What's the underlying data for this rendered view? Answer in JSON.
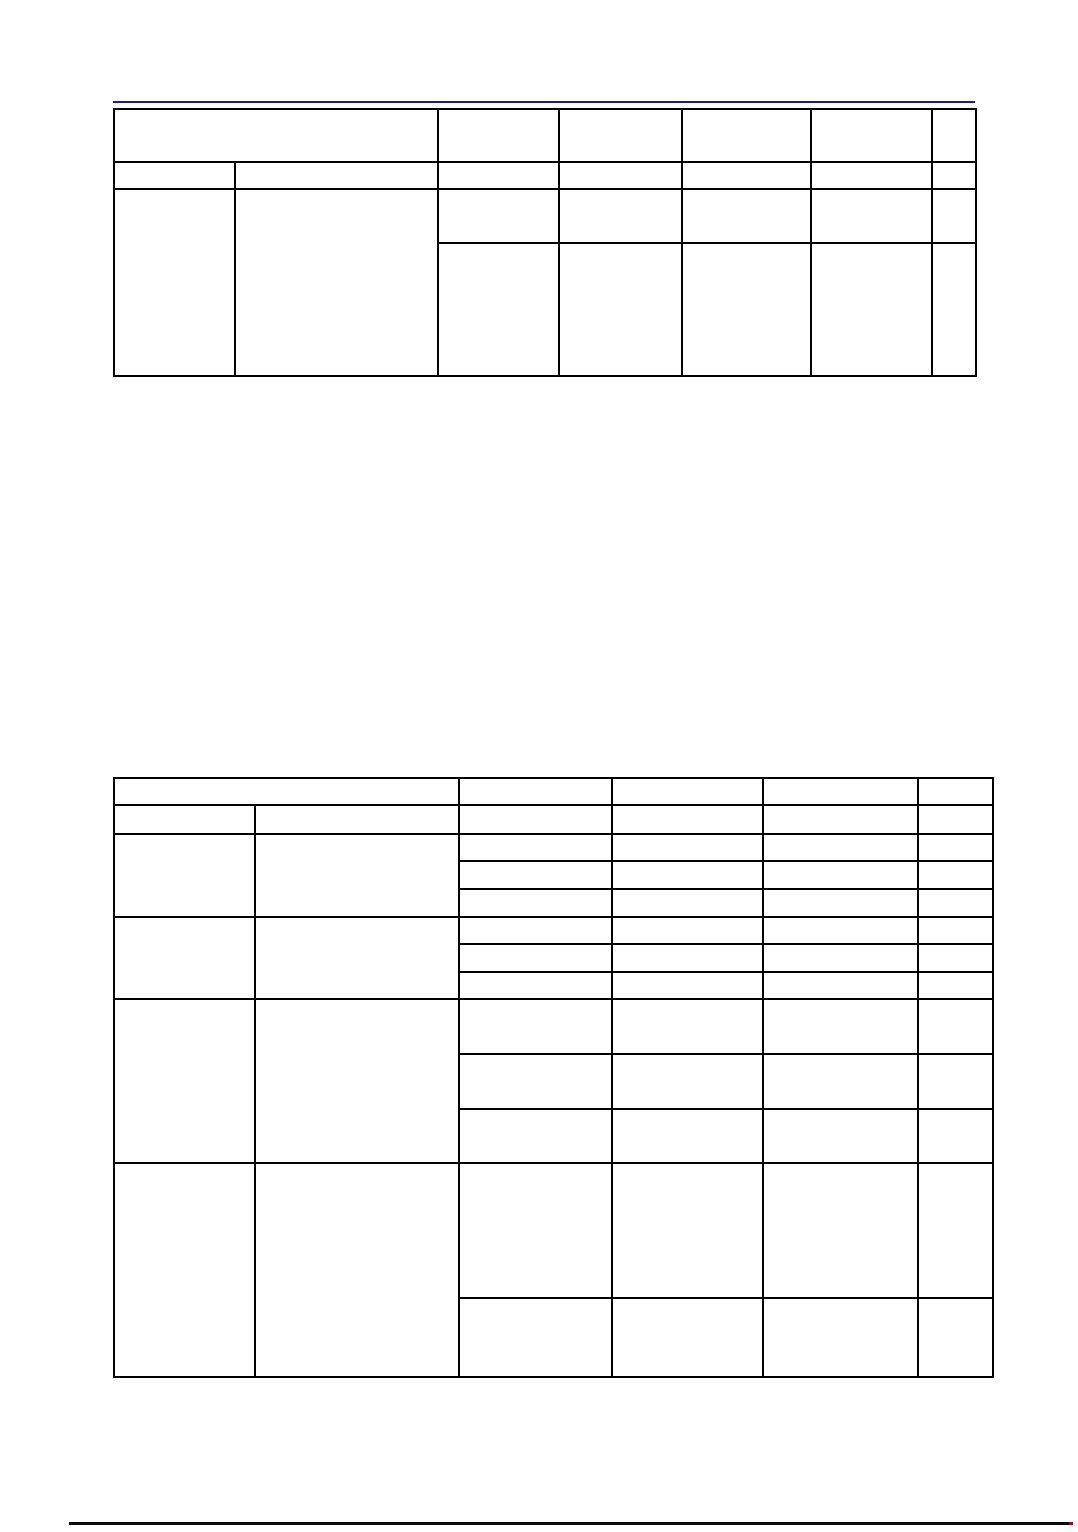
{
  "document": {
    "page_background": "#ffffff",
    "visible_text": "",
    "colors": {
      "header_rule": "#1e1a96",
      "table_border": "#000000",
      "footer_rule": "#0a0a0a",
      "footer_end_mark": "#b20000"
    },
    "upper_table": {
      "column_count": 7,
      "row_count": 4,
      "cell_text": ""
    },
    "lower_table": {
      "column_count": 6,
      "row_count": 13,
      "cell_text": ""
    }
  }
}
